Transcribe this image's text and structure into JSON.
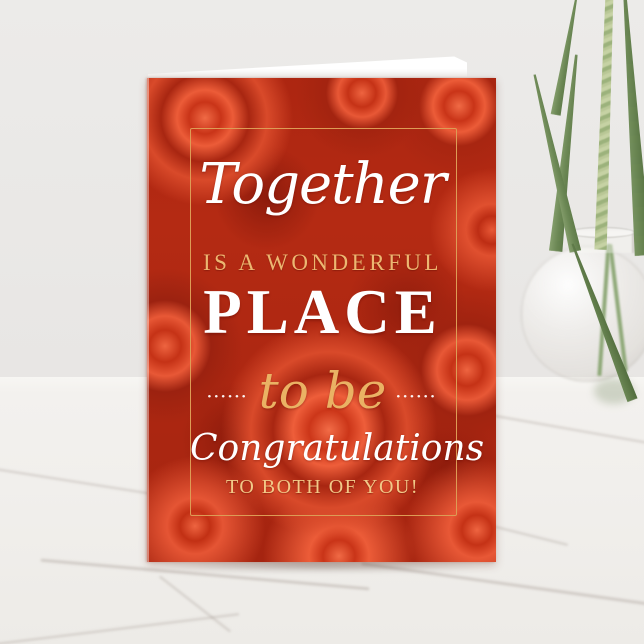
{
  "card": {
    "line_together": "Together",
    "line_is_a_wonderful": "IS A WONDERFUL",
    "line_place": "PLACE",
    "dots_left": "••••••",
    "line_to_be": "to be",
    "dots_right": "••••••",
    "line_congratulations": "Congratulations",
    "line_to_both": "TO BOTH OF YOU!"
  },
  "colors": {
    "card_red": "#c23018",
    "card_red_dark": "#8f1f0d",
    "card_red_light": "#ec5c38",
    "frame_gold": "#dd9c55",
    "gold_text": "#ecb771",
    "pale_gold_text": "#f2c988",
    "white_text": "#ffffff",
    "wall_gray": "#e9e7e5",
    "marble_white": "#f3f1ee",
    "leaf_green": "#6b8754",
    "wheat_green": "#c6d2a4"
  }
}
